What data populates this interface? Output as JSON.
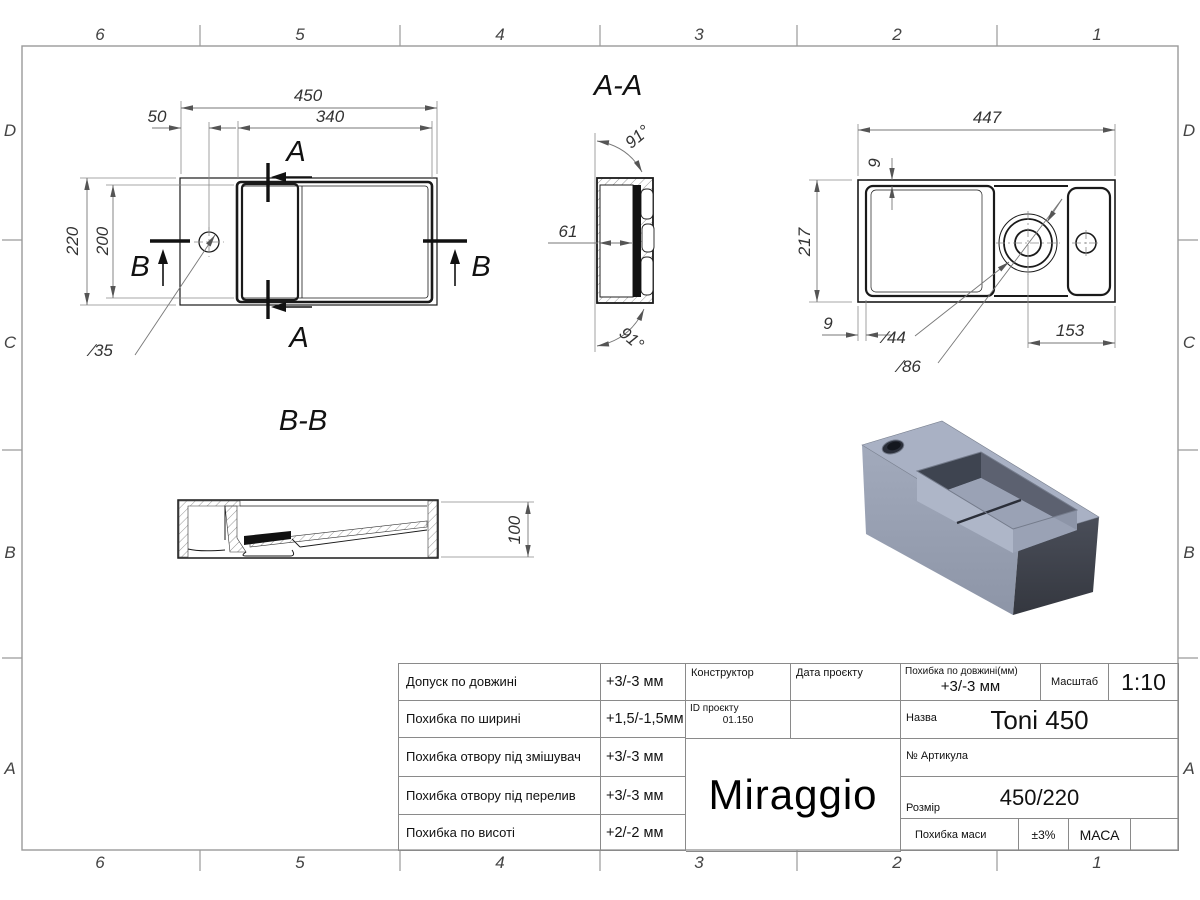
{
  "sheet": {
    "zones": {
      "cols": [
        "6",
        "5",
        "4",
        "3",
        "2",
        "1"
      ],
      "rows": [
        "D",
        "C",
        "B",
        "A"
      ]
    }
  },
  "views": {
    "plan": {
      "width": "450",
      "basin_width": "340",
      "faucet_offset": "50",
      "depth": "220",
      "basin_depth": "200",
      "faucet_hole": "∕35",
      "cut_a": "A",
      "cut_b": "B"
    },
    "section_aa": {
      "title": "A-A",
      "angle_top": "91°",
      "angle_bottom": "91°",
      "wall_width": "61"
    },
    "bottom": {
      "width": "447",
      "depth": "217",
      "rim_top": "9",
      "rim_left": "9",
      "drain_hole": "∕44",
      "drain_recess": "∕86",
      "drain_offset": "153"
    },
    "section_bb": {
      "title": "B-B",
      "height": "100"
    }
  },
  "title_block": {
    "tolerances": [
      {
        "label": "Допуск по довжині",
        "value": "+3/-3 мм"
      },
      {
        "label": "Похибка по ширині",
        "value": "+1,5/-1,5мм"
      },
      {
        "label": "Похибка отвору під змішувач",
        "value": "+3/-3 мм"
      },
      {
        "label": "Похибка отвору під перелив",
        "value": "+3/-3 мм"
      },
      {
        "label": "Похибка по висоті",
        "value": "+2/-2 мм"
      }
    ],
    "constructor_label": "Конструктор",
    "project_date_label": "Дата проєкту",
    "project_id_label": "ID проєкту",
    "project_id_value": "01.150",
    "brand": "Miraggio",
    "length_tolerance_label": "Похибка по довжині(мм)",
    "length_tolerance_value": "+3/-3 мм",
    "scale_label": "Масштаб",
    "scale_value": "1:10",
    "name_label": "Назва",
    "name_value": "Toni 450",
    "article_label": "№ Артикула",
    "size_label": "Розмір",
    "size_value": "450/220",
    "mass_tolerance_label": "Похибка маси",
    "mass_tolerance_value": "±3%",
    "mass_label": "МАСА"
  }
}
